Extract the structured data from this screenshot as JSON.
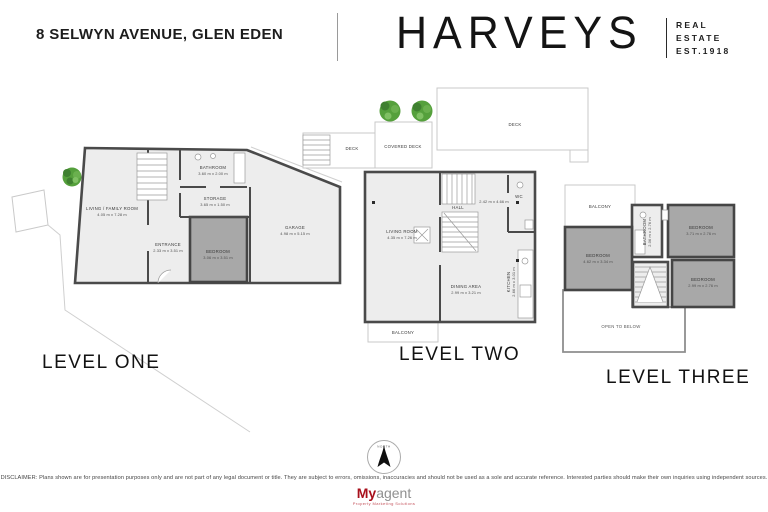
{
  "header": {
    "address": "8 SELWYN AVENUE, GLEN EDEN",
    "brand_name": "HARVEYS",
    "brand_lines": {
      "l1": "REAL",
      "l2": "ESTATE",
      "l3": "EST.1918"
    }
  },
  "levels": [
    {
      "name": "LEVEL ONE",
      "rooms": [
        {
          "label": "LIVING / FAMILY ROOM",
          "dims": "4.05 m x 7.28 m"
        },
        {
          "label": "BATHROOM",
          "dims": "3.60 m x 2.00 m"
        },
        {
          "label": "STORAGE",
          "dims": "3.65 m x 1.50 m"
        },
        {
          "label": "ENTRANCE",
          "dims": "2.33 m x 3.51 m"
        },
        {
          "label": "BEDROOM",
          "dims": "3.06 m x 3.51 m"
        },
        {
          "label": "GARAGE",
          "dims": "4.98 m x 5.15 m"
        }
      ]
    },
    {
      "name": "LEVEL TWO",
      "rooms": [
        {
          "label": "DECK"
        },
        {
          "label": "COVERED DECK"
        },
        {
          "label": "DECK"
        },
        {
          "label": "LIVING ROOM",
          "dims": "4.35 m x 7.26 m"
        },
        {
          "label": "HALL"
        },
        {
          "dims": "2.42 m x 4.66 m"
        },
        {
          "label": "WC"
        },
        {
          "label": "DINING AREA",
          "dims": "2.99 m x 3.21 m"
        },
        {
          "label": "KITCHEN",
          "dims": "2.66 m x 3.01 m"
        },
        {
          "label": "BALCONY"
        }
      ]
    },
    {
      "name": "LEVEL THREE",
      "rooms": [
        {
          "label": "BALCONY"
        },
        {
          "label": "BATHROOM",
          "dims": "2.06 m x 2.76 m"
        },
        {
          "label": "BEDROOM",
          "dims": "3.71 m x 2.76 m"
        },
        {
          "label": "BEDROOM",
          "dims": "4.62 m x 3.34 m"
        },
        {
          "label": "BEDROOM",
          "dims": "2.99 m x 2.76 m"
        },
        {
          "label": "OPEN TO BELOW"
        }
      ]
    }
  ],
  "footer": {
    "compass_label": "NORTH",
    "disclaimer": "DISCLAIMER: Plans shown are for presentation purposes only and are not part of any legal document or title. They are subject to errors, omissions, inaccuracies and should not be used as a sole and accurate reference. Interested parties should make their own inquiries using independent sources.",
    "logo": {
      "prefix": "My",
      "suffix": "agent",
      "tagline": "Property Marketing Solutions"
    }
  },
  "colors": {
    "wall": "#4a4a4a",
    "room_fill": "#ededed",
    "dark_room_fill": "#a8a8a8",
    "boundary_line": "#cfcfcf",
    "tree_green": "#55a03c",
    "logo_red": "#a8101c",
    "logo_gray": "#909090"
  }
}
